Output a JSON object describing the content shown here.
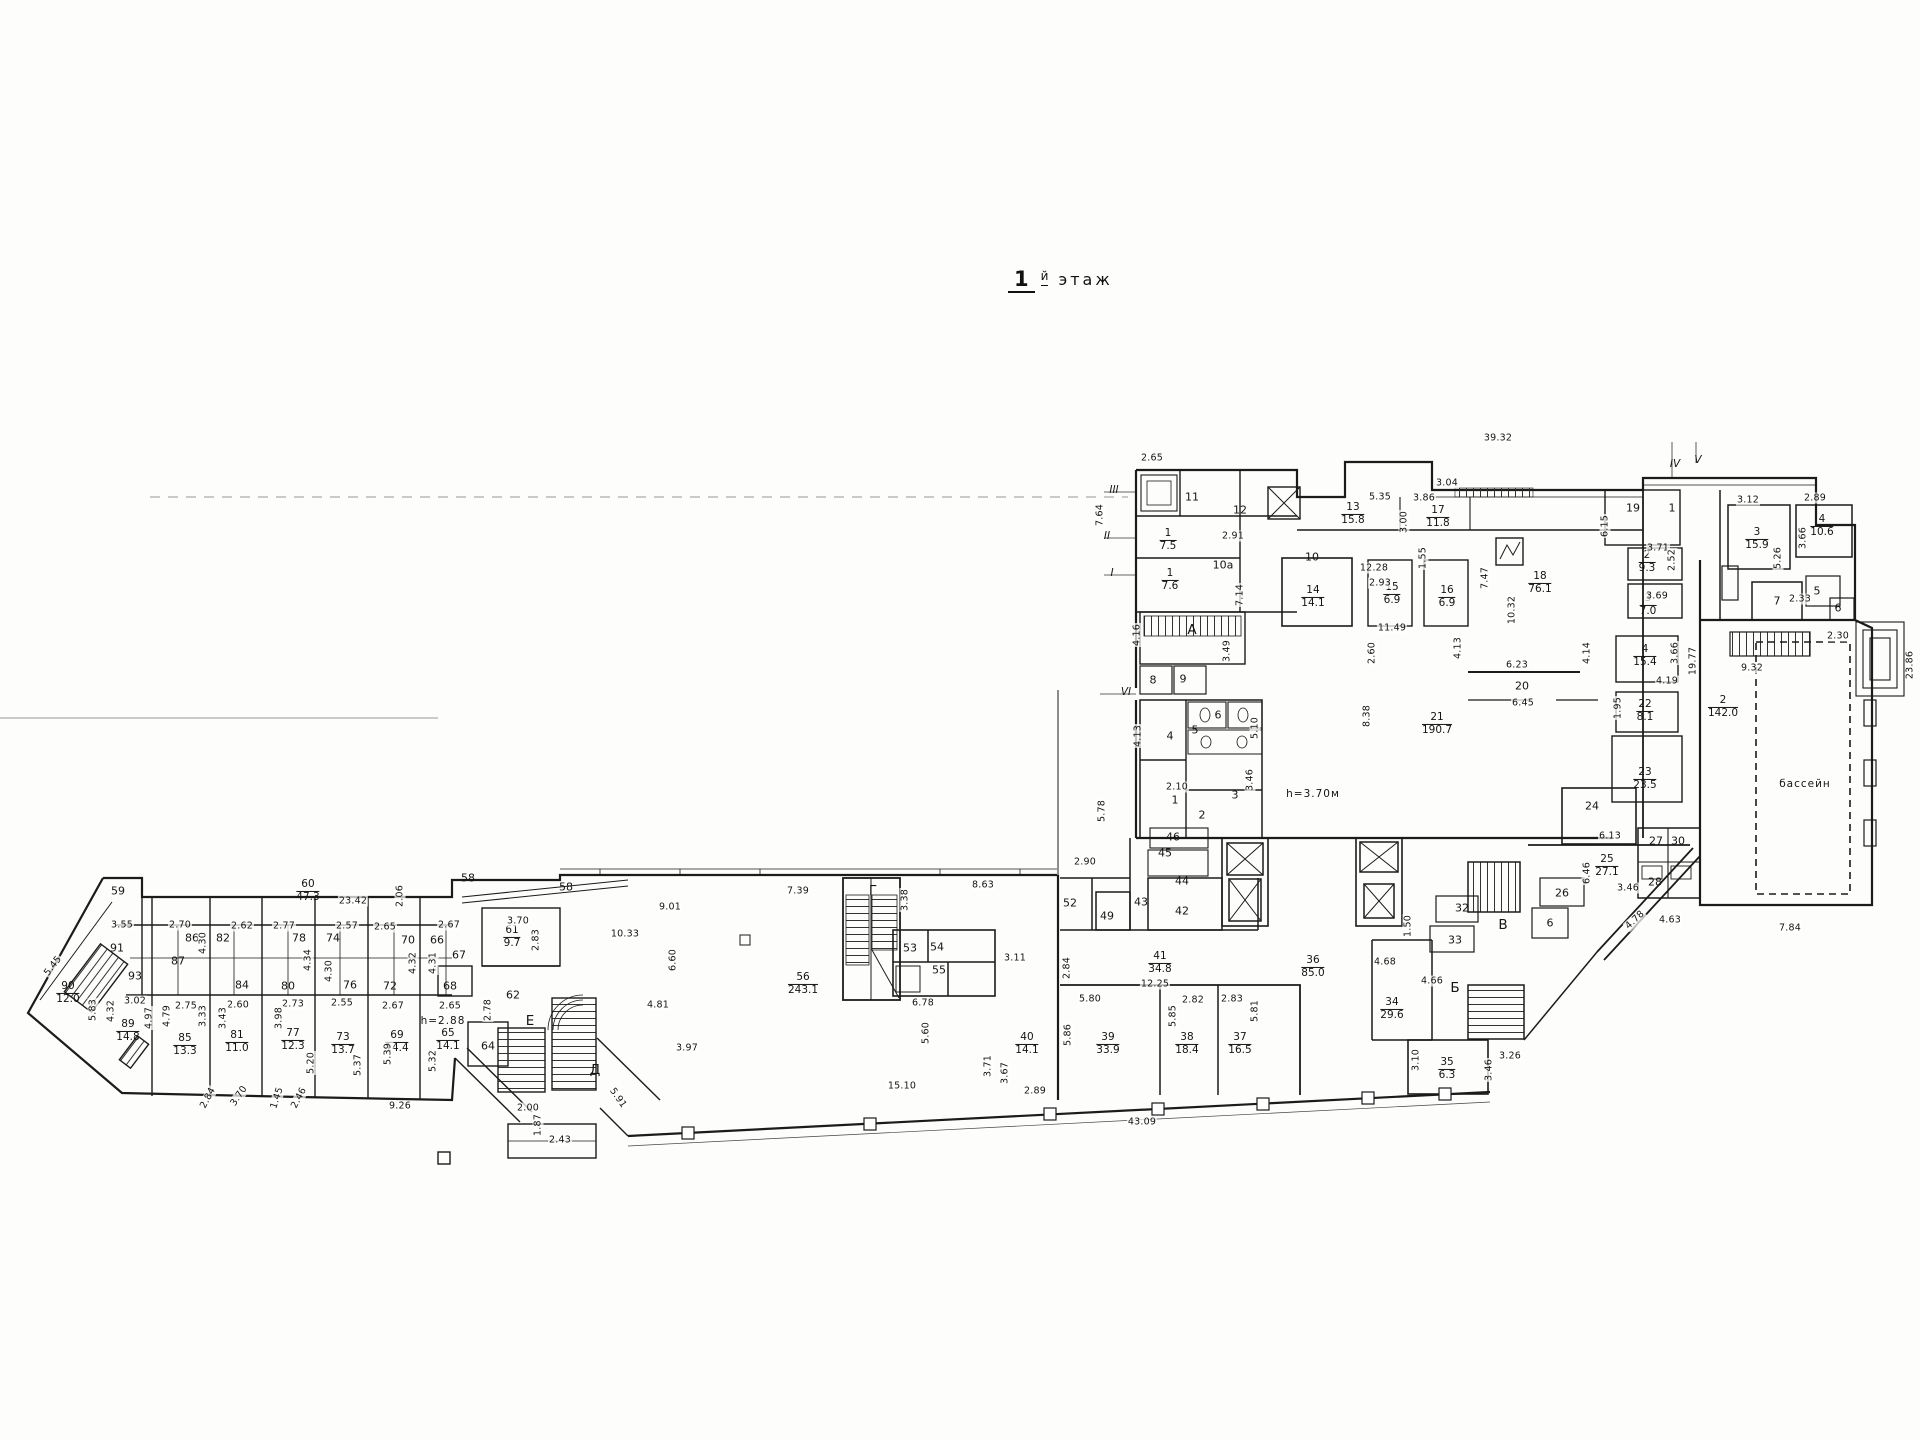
{
  "title": {
    "number": "1",
    "suffix": "й",
    "word": "этаж"
  },
  "colors": {
    "ink": "#1b1b1b",
    "paper": "#fdfdfc"
  },
  "plan": {
    "rooms": [
      {
        "n": "90",
        "a": "12.0",
        "x": 68,
        "y": 993
      },
      {
        "n": "89",
        "a": "14.8",
        "x": 128,
        "y": 1031
      },
      {
        "n": "85",
        "a": "13.3",
        "x": 185,
        "y": 1045
      },
      {
        "n": "81",
        "a": "11.0",
        "x": 237,
        "y": 1042
      },
      {
        "n": "77",
        "a": "12.3",
        "x": 293,
        "y": 1040
      },
      {
        "n": "73",
        "a": "13.7",
        "x": 343,
        "y": 1044
      },
      {
        "n": "69",
        "a": "14.4",
        "x": 397,
        "y": 1042
      },
      {
        "n": "65",
        "a": "14.1",
        "x": 448,
        "y": 1040
      },
      {
        "n": "61",
        "a": "9.7",
        "x": 512,
        "y": 937
      },
      {
        "n": "60",
        "a": "47.3",
        "x": 308,
        "y": 891
      },
      {
        "n": "56",
        "a": "243.1",
        "x": 803,
        "y": 984
      },
      {
        "n": "1",
        "a": "7.5",
        "x": 1168,
        "y": 540
      },
      {
        "n": "1",
        "a": "7.6",
        "x": 1170,
        "y": 580
      },
      {
        "n": "13",
        "a": "15.8",
        "x": 1353,
        "y": 514
      },
      {
        "n": "17",
        "a": "11.8",
        "x": 1438,
        "y": 517
      },
      {
        "n": "14",
        "a": "14.1",
        "x": 1313,
        "y": 597
      },
      {
        "n": "15",
        "a": "6.9",
        "x": 1392,
        "y": 594
      },
      {
        "n": "16",
        "a": "6.9",
        "x": 1447,
        "y": 597
      },
      {
        "n": "18",
        "a": "76.1",
        "x": 1540,
        "y": 583
      },
      {
        "n": "2",
        "a": "9.3",
        "x": 1647,
        "y": 562
      },
      {
        "n": "3",
        "a": "7.0",
        "x": 1648,
        "y": 605
      },
      {
        "n": "3",
        "a": "15.9",
        "x": 1757,
        "y": 539
      },
      {
        "n": "4",
        "a": "10.6",
        "x": 1822,
        "y": 526
      },
      {
        "n": "4",
        "a": "15.4",
        "x": 1645,
        "y": 656
      },
      {
        "n": "22",
        "a": "8.1",
        "x": 1645,
        "y": 711
      },
      {
        "n": "23",
        "a": "23.5",
        "x": 1645,
        "y": 779
      },
      {
        "n": "21",
        "a": "190.7",
        "x": 1437,
        "y": 724
      },
      {
        "n": "2",
        "a": "142.0",
        "x": 1723,
        "y": 707
      },
      {
        "n": "25",
        "a": "27.1",
        "x": 1607,
        "y": 866
      },
      {
        "n": "34",
        "a": "29.6",
        "x": 1392,
        "y": 1009
      },
      {
        "n": "35",
        "a": "6.3",
        "x": 1447,
        "y": 1069
      },
      {
        "n": "36",
        "a": "85.0",
        "x": 1313,
        "y": 967
      },
      {
        "n": "41",
        "a": "34.8",
        "x": 1160,
        "y": 963
      },
      {
        "n": "39",
        "a": "33.9",
        "x": 1108,
        "y": 1044
      },
      {
        "n": "38",
        "a": "18.4",
        "x": 1187,
        "y": 1044
      },
      {
        "n": "37",
        "a": "16.5",
        "x": 1240,
        "y": 1044
      },
      {
        "n": "40",
        "a": "14.1",
        "x": 1027,
        "y": 1044
      }
    ],
    "numbers": [
      {
        "t": "59",
        "x": 118,
        "y": 891
      },
      {
        "t": "91",
        "x": 117,
        "y": 948
      },
      {
        "t": "93",
        "x": 135,
        "y": 976
      },
      {
        "t": "86",
        "x": 192,
        "y": 938
      },
      {
        "t": "87",
        "x": 178,
        "y": 961
      },
      {
        "t": "82",
        "x": 223,
        "y": 938
      },
      {
        "t": "84",
        "x": 242,
        "y": 985
      },
      {
        "t": "78",
        "x": 299,
        "y": 938
      },
      {
        "t": "80",
        "x": 288,
        "y": 986
      },
      {
        "t": "74",
        "x": 333,
        "y": 938
      },
      {
        "t": "76",
        "x": 350,
        "y": 985
      },
      {
        "t": "70",
        "x": 408,
        "y": 940
      },
      {
        "t": "72",
        "x": 390,
        "y": 986
      },
      {
        "t": "66",
        "x": 437,
        "y": 940
      },
      {
        "t": "67",
        "x": 459,
        "y": 955
      },
      {
        "t": "68",
        "x": 450,
        "y": 986
      },
      {
        "t": "58",
        "x": 468,
        "y": 878
      },
      {
        "t": "58",
        "x": 566,
        "y": 887
      },
      {
        "t": "62",
        "x": 513,
        "y": 995
      },
      {
        "t": "64",
        "x": 488,
        "y": 1046
      },
      {
        "t": "11",
        "x": 1192,
        "y": 497
      },
      {
        "t": "12",
        "x": 1240,
        "y": 510
      },
      {
        "t": "10а",
        "x": 1223,
        "y": 565
      },
      {
        "t": "10",
        "x": 1312,
        "y": 557
      },
      {
        "t": "19",
        "x": 1633,
        "y": 508
      },
      {
        "t": "1",
        "x": 1672,
        "y": 508
      },
      {
        "t": "7",
        "x": 1777,
        "y": 601
      },
      {
        "t": "5",
        "x": 1817,
        "y": 591
      },
      {
        "t": "6",
        "x": 1838,
        "y": 608
      },
      {
        "t": "20",
        "x": 1522,
        "y": 686
      },
      {
        "t": "24",
        "x": 1592,
        "y": 806
      },
      {
        "t": "26",
        "x": 1562,
        "y": 893
      },
      {
        "t": "27",
        "x": 1656,
        "y": 841
      },
      {
        "t": "30",
        "x": 1678,
        "y": 841
      },
      {
        "t": "28",
        "x": 1655,
        "y": 882
      },
      {
        "t": "32",
        "x": 1462,
        "y": 908
      },
      {
        "t": "33",
        "x": 1455,
        "y": 940
      },
      {
        "t": "6",
        "x": 1550,
        "y": 923
      },
      {
        "t": "42",
        "x": 1182,
        "y": 911
      },
      {
        "t": "43",
        "x": 1141,
        "y": 902
      },
      {
        "t": "44",
        "x": 1182,
        "y": 881
      },
      {
        "t": "45",
        "x": 1165,
        "y": 853
      },
      {
        "t": "46",
        "x": 1173,
        "y": 837
      },
      {
        "t": "49",
        "x": 1107,
        "y": 916
      },
      {
        "t": "52",
        "x": 1070,
        "y": 903
      },
      {
        "t": "53",
        "x": 910,
        "y": 948
      },
      {
        "t": "54",
        "x": 937,
        "y": 947
      },
      {
        "t": "55",
        "x": 939,
        "y": 970
      },
      {
        "t": "8",
        "x": 1153,
        "y": 680
      },
      {
        "t": "9",
        "x": 1183,
        "y": 679
      },
      {
        "t": "4",
        "x": 1170,
        "y": 736
      },
      {
        "t": "5",
        "x": 1195,
        "y": 730
      },
      {
        "t": "6",
        "x": 1218,
        "y": 715
      },
      {
        "t": "1",
        "x": 1175,
        "y": 800
      },
      {
        "t": "2",
        "x": 1202,
        "y": 815
      },
      {
        "t": "3",
        "x": 1235,
        "y": 795
      }
    ],
    "letters": [
      {
        "t": "А",
        "x": 1192,
        "y": 630
      },
      {
        "t": "Б",
        "x": 1455,
        "y": 988
      },
      {
        "t": "В",
        "x": 1503,
        "y": 925
      },
      {
        "t": "Г",
        "x": 873,
        "y": 891
      },
      {
        "t": "Д",
        "x": 595,
        "y": 1070
      },
      {
        "t": "Е",
        "x": 530,
        "y": 1021
      }
    ],
    "romans": [
      {
        "t": "I",
        "x": 1112,
        "y": 573
      },
      {
        "t": "II",
        "x": 1107,
        "y": 536
      },
      {
        "t": "III",
        "x": 1114,
        "y": 490
      },
      {
        "t": "IV",
        "x": 1675,
        "y": 464
      },
      {
        "t": "V",
        "x": 1698,
        "y": 460
      },
      {
        "t": "VI",
        "x": 1126,
        "y": 692
      }
    ],
    "notes": [
      {
        "t": "бассейн",
        "x": 1805,
        "y": 784
      },
      {
        "t": "h=3.70м",
        "x": 1313,
        "y": 794
      },
      {
        "t": "h=2.88",
        "x": 443,
        "y": 1021
      }
    ],
    "dims": [
      {
        "t": "2.65",
        "x": 1152,
        "y": 458
      },
      {
        "t": "39.32",
        "x": 1498,
        "y": 438
      },
      {
        "t": "5.35",
        "x": 1380,
        "y": 497
      },
      {
        "t": "3.86",
        "x": 1424,
        "y": 498
      },
      {
        "t": "3.04",
        "x": 1447,
        "y": 483
      },
      {
        "t": "2.91",
        "x": 1233,
        "y": 536
      },
      {
        "t": "12.28",
        "x": 1374,
        "y": 568
      },
      {
        "t": "2.93",
        "x": 1380,
        "y": 583
      },
      {
        "t": "11.49",
        "x": 1392,
        "y": 628
      },
      {
        "t": "6.23",
        "x": 1517,
        "y": 665
      },
      {
        "t": "6.45",
        "x": 1523,
        "y": 703
      },
      {
        "t": "4.19",
        "x": 1667,
        "y": 681
      },
      {
        "t": "3.71",
        "x": 1658,
        "y": 548
      },
      {
        "t": "3.69",
        "x": 1657,
        "y": 596
      },
      {
        "t": "3.12",
        "x": 1748,
        "y": 500
      },
      {
        "t": "2.89",
        "x": 1815,
        "y": 498
      },
      {
        "t": "2.33",
        "x": 1800,
        "y": 599
      },
      {
        "t": "9.32",
        "x": 1752,
        "y": 668
      },
      {
        "t": "2.30",
        "x": 1838,
        "y": 636
      },
      {
        "t": "6.13",
        "x": 1610,
        "y": 836
      },
      {
        "t": "3.46",
        "x": 1628,
        "y": 888
      },
      {
        "t": "4.63",
        "x": 1670,
        "y": 920
      },
      {
        "t": "7.84",
        "x": 1790,
        "y": 928
      },
      {
        "t": "8.63",
        "x": 983,
        "y": 885
      },
      {
        "t": "7.39",
        "x": 798,
        "y": 891
      },
      {
        "t": "9.01",
        "x": 670,
        "y": 907
      },
      {
        "t": "10.33",
        "x": 625,
        "y": 934
      },
      {
        "t": "4.81",
        "x": 658,
        "y": 1005
      },
      {
        "t": "3.97",
        "x": 687,
        "y": 1048
      },
      {
        "t": "15.10",
        "x": 902,
        "y": 1086
      },
      {
        "t": "2.43",
        "x": 560,
        "y": 1140
      },
      {
        "t": "2.00",
        "x": 528,
        "y": 1108
      },
      {
        "t": "6.78",
        "x": 923,
        "y": 1003
      },
      {
        "t": "3.11",
        "x": 1015,
        "y": 958
      },
      {
        "t": "12.25",
        "x": 1155,
        "y": 984
      },
      {
        "t": "5.80",
        "x": 1090,
        "y": 999
      },
      {
        "t": "2.82",
        "x": 1193,
        "y": 1000
      },
      {
        "t": "2.83",
        "x": 1232,
        "y": 999
      },
      {
        "t": "2.89",
        "x": 1035,
        "y": 1091
      },
      {
        "t": "43.09",
        "x": 1142,
        "y": 1122
      },
      {
        "t": "2.90",
        "x": 1085,
        "y": 862
      },
      {
        "t": "2.10",
        "x": 1177,
        "y": 787
      },
      {
        "t": "23.42",
        "x": 353,
        "y": 901
      },
      {
        "t": "3.55",
        "x": 122,
        "y": 925
      },
      {
        "t": "2.70",
        "x": 180,
        "y": 925
      },
      {
        "t": "2.62",
        "x": 242,
        "y": 926
      },
      {
        "t": "2.77",
        "x": 284,
        "y": 926
      },
      {
        "t": "2.57",
        "x": 347,
        "y": 926
      },
      {
        "t": "2.65",
        "x": 385,
        "y": 927
      },
      {
        "t": "2.67",
        "x": 449,
        "y": 925
      },
      {
        "t": "3.70",
        "x": 518,
        "y": 921
      },
      {
        "t": "3.02",
        "x": 135,
        "y": 1001
      },
      {
        "t": "2.75",
        "x": 186,
        "y": 1006
      },
      {
        "t": "2.60",
        "x": 238,
        "y": 1005
      },
      {
        "t": "2.73",
        "x": 293,
        "y": 1004
      },
      {
        "t": "2.55",
        "x": 342,
        "y": 1003
      },
      {
        "t": "2.67",
        "x": 393,
        "y": 1006
      },
      {
        "t": "2.65",
        "x": 450,
        "y": 1006
      },
      {
        "t": "9.26",
        "x": 400,
        "y": 1106
      },
      {
        "t": "3.26",
        "x": 1510,
        "y": 1056
      },
      {
        "t": "4.66",
        "x": 1432,
        "y": 981
      },
      {
        "t": "4.68",
        "x": 1385,
        "y": 962
      },
      {
        "t": "7.64",
        "x": 1100,
        "y": 515,
        "r": -90
      },
      {
        "t": "3.00",
        "x": 1404,
        "y": 522,
        "r": -90
      },
      {
        "t": "1.55",
        "x": 1423,
        "y": 558,
        "r": -90
      },
      {
        "t": "7.47",
        "x": 1485,
        "y": 578,
        "r": -90
      },
      {
        "t": "10.32",
        "x": 1512,
        "y": 610,
        "r": -90
      },
      {
        "t": "6.15",
        "x": 1605,
        "y": 526,
        "r": -90
      },
      {
        "t": "2.52",
        "x": 1672,
        "y": 560,
        "r": -90
      },
      {
        "t": "3.66",
        "x": 1803,
        "y": 538,
        "r": -90
      },
      {
        "t": "5.26",
        "x": 1778,
        "y": 558,
        "r": -90
      },
      {
        "t": "3.66",
        "x": 1675,
        "y": 653,
        "r": -90
      },
      {
        "t": "4.13",
        "x": 1458,
        "y": 648,
        "r": -90
      },
      {
        "t": "4.14",
        "x": 1587,
        "y": 653,
        "r": -90
      },
      {
        "t": "1.95",
        "x": 1618,
        "y": 708,
        "r": -90
      },
      {
        "t": "19.77",
        "x": 1693,
        "y": 661,
        "r": -90
      },
      {
        "t": "23.86",
        "x": 1910,
        "y": 665,
        "r": -90
      },
      {
        "t": "6.46",
        "x": 1587,
        "y": 873,
        "r": -90
      },
      {
        "t": "1.50",
        "x": 1408,
        "y": 926,
        "r": -90
      },
      {
        "t": "2.60",
        "x": 1372,
        "y": 653,
        "r": -90
      },
      {
        "t": "8.38",
        "x": 1367,
        "y": 716,
        "r": -90
      },
      {
        "t": "4.16",
        "x": 1137,
        "y": 635,
        "r": -90
      },
      {
        "t": "4.13",
        "x": 1138,
        "y": 736,
        "r": -90
      },
      {
        "t": "3.49",
        "x": 1227,
        "y": 651,
        "r": -90
      },
      {
        "t": "7.14",
        "x": 1240,
        "y": 595,
        "r": -90
      },
      {
        "t": "5.10",
        "x": 1255,
        "y": 728,
        "r": -90
      },
      {
        "t": "3.46",
        "x": 1250,
        "y": 780,
        "r": -90
      },
      {
        "t": "5.78",
        "x": 1102,
        "y": 811,
        "r": -90
      },
      {
        "t": "3.38",
        "x": 905,
        "y": 900,
        "r": -90
      },
      {
        "t": "6.60",
        "x": 673,
        "y": 960,
        "r": -90
      },
      {
        "t": "5.60",
        "x": 926,
        "y": 1033,
        "r": -90
      },
      {
        "t": "2.84",
        "x": 1067,
        "y": 968,
        "r": -90
      },
      {
        "t": "5.86",
        "x": 1068,
        "y": 1035,
        "r": -90
      },
      {
        "t": "5.85",
        "x": 1173,
        "y": 1016,
        "r": -90
      },
      {
        "t": "5.81",
        "x": 1255,
        "y": 1011,
        "r": -90
      },
      {
        "t": "3.71",
        "x": 988,
        "y": 1066,
        "r": -90
      },
      {
        "t": "3.67",
        "x": 1005,
        "y": 1073,
        "r": -90
      },
      {
        "t": "3.10",
        "x": 1416,
        "y": 1060,
        "r": -90
      },
      {
        "t": "3.46",
        "x": 1489,
        "y": 1070,
        "r": -90
      },
      {
        "t": "4.30",
        "x": 203,
        "y": 943,
        "r": -90
      },
      {
        "t": "4.34",
        "x": 308,
        "y": 960,
        "r": -90
      },
      {
        "t": "4.30",
        "x": 329,
        "y": 971,
        "r": -90
      },
      {
        "t": "4.32",
        "x": 413,
        "y": 963,
        "r": -90
      },
      {
        "t": "4.31",
        "x": 433,
        "y": 963,
        "r": -90
      },
      {
        "t": "4.32",
        "x": 111,
        "y": 1011,
        "r": -90
      },
      {
        "t": "4.97",
        "x": 149,
        "y": 1018,
        "r": -90
      },
      {
        "t": "4.79",
        "x": 167,
        "y": 1016,
        "r": -90
      },
      {
        "t": "3.33",
        "x": 203,
        "y": 1016,
        "r": -90
      },
      {
        "t": "3.43",
        "x": 223,
        "y": 1018,
        "r": -90
      },
      {
        "t": "3.98",
        "x": 279,
        "y": 1018,
        "r": -90
      },
      {
        "t": "5.83",
        "x": 93,
        "y": 1010,
        "r": -90
      },
      {
        "t": "5.20",
        "x": 311,
        "y": 1063,
        "r": -90
      },
      {
        "t": "5.37",
        "x": 358,
        "y": 1065,
        "r": -90
      },
      {
        "t": "5.39",
        "x": 388,
        "y": 1054,
        "r": -90
      },
      {
        "t": "5.32",
        "x": 433,
        "y": 1061,
        "r": -90
      },
      {
        "t": "2.83",
        "x": 536,
        "y": 940,
        "r": -90
      },
      {
        "t": "2.78",
        "x": 488,
        "y": 1010,
        "r": -90
      },
      {
        "t": "1.87",
        "x": 538,
        "y": 1125,
        "r": -90
      },
      {
        "t": "2.06",
        "x": 400,
        "y": 896,
        "r": -90
      },
      {
        "t": "5.45",
        "x": 53,
        "y": 966,
        "r": -52
      },
      {
        "t": "2.84",
        "x": 208,
        "y": 1098,
        "r": -62
      },
      {
        "t": "3.70",
        "x": 239,
        "y": 1096,
        "r": -56
      },
      {
        "t": "1.45",
        "x": 277,
        "y": 1098,
        "r": -72
      },
      {
        "t": "2.46",
        "x": 299,
        "y": 1098,
        "r": -62
      },
      {
        "t": "5.91",
        "x": 618,
        "y": 1098,
        "r": 55
      },
      {
        "t": "4.78",
        "x": 1635,
        "y": 920,
        "r": -43
      }
    ]
  }
}
